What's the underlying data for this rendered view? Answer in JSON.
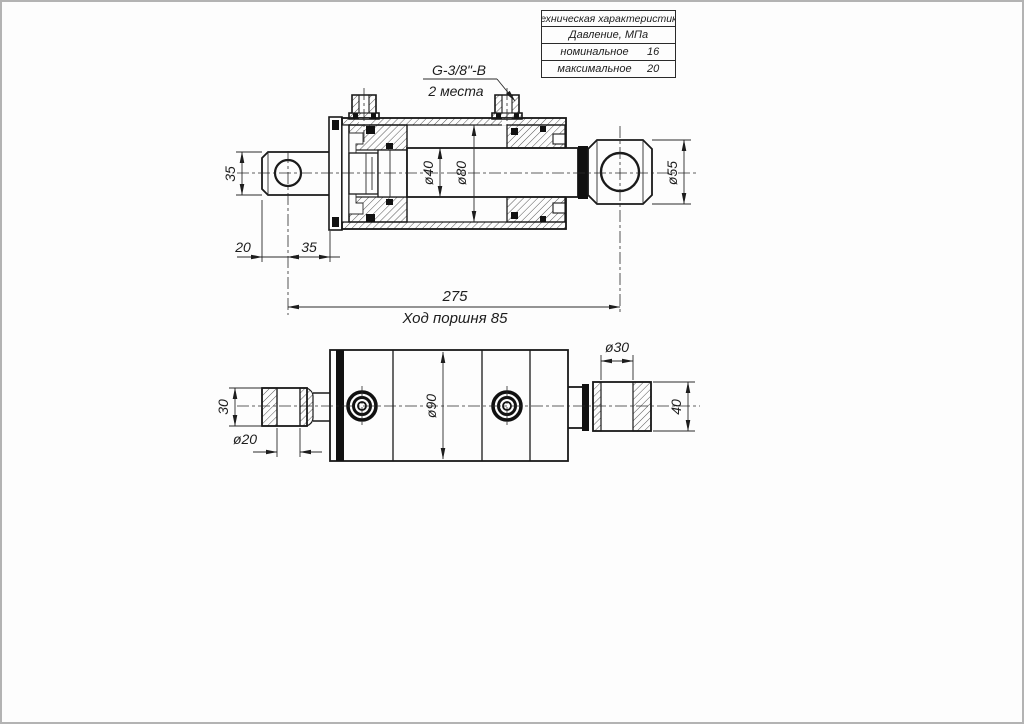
{
  "page": {
    "background": "#fdfdfd",
    "frame_color": "#b3b3b3",
    "line_color": "#1a1a1a"
  },
  "table": {
    "title": "Техническая характеристика",
    "subtitle": "Давление, МПа",
    "rows": [
      {
        "label": "номинальное",
        "value": "16"
      },
      {
        "label": "максимальное",
        "value": "20"
      }
    ]
  },
  "main_view": {
    "port_thread_label": "G-3/8\"-B",
    "port_places_label": "2 места",
    "dims": {
      "eye_height": "35",
      "eye_offset": "20",
      "eye_to_flange": "35",
      "rod_diameter": "ø40",
      "bore_diameter": "ø80",
      "head_eye_diameter": "ø55",
      "overall_length": "275",
      "stroke_label": "Ход поршня 85"
    }
  },
  "bottom_view": {
    "dims": {
      "eye_width": "30",
      "eye_bore": "ø20",
      "body_diameter": "ø90",
      "head_eye_bore": "ø30",
      "head_eye_width": "40"
    }
  }
}
